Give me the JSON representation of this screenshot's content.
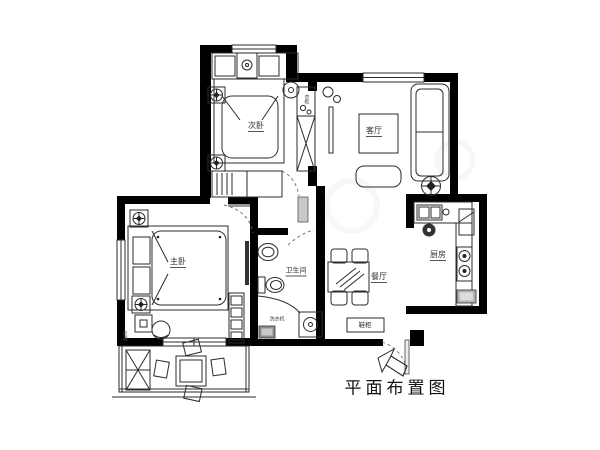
{
  "title": "平面布置图",
  "rooms": {
    "secondary_bedroom": "次卧",
    "living_room": "客厅",
    "master_bedroom": "主卧",
    "bathroom": "卫生间",
    "dining_room": "餐厅",
    "kitchen": "厨房"
  },
  "annotations": {
    "shoe_cabinet": "鞋柜",
    "washing_machine": "洗衣机",
    "wardrobe": "衣柜",
    "air_conditioner": "空调"
  },
  "colors": {
    "wall": "#000000",
    "line": "#2b2b2b",
    "background": "#ffffff"
  }
}
